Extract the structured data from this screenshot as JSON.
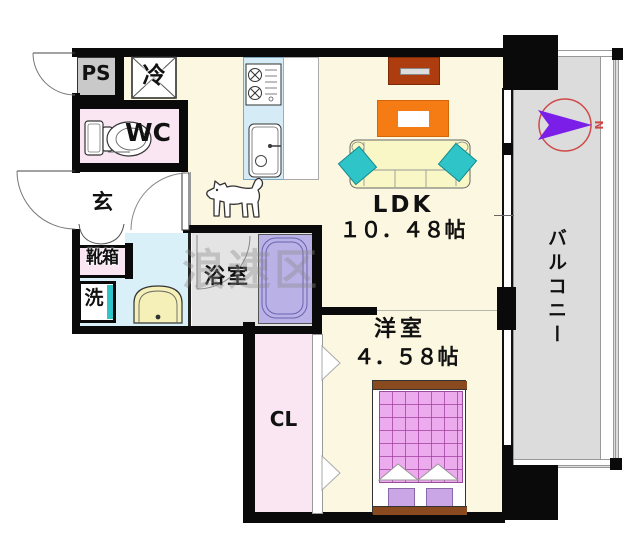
{
  "watermark": {
    "text": "浪速区"
  },
  "rooms": {
    "ps": {
      "label": "PS"
    },
    "fridge": {
      "label": "冷"
    },
    "wc": {
      "label": "WC"
    },
    "genkan": {
      "label": "玄"
    },
    "shoebox": {
      "label": "靴箱"
    },
    "laundry": {
      "label": "洗"
    },
    "bathroom": {
      "label": "浴室"
    },
    "closet": {
      "label": "CL"
    },
    "ldk": {
      "label": "LDK",
      "size": "１０．４８帖"
    },
    "bedroom": {
      "label": "洋室",
      "size": "４．５８帖"
    },
    "balcony": {
      "label": "バルコニー"
    }
  },
  "compass": {
    "north_label": "N"
  },
  "colors": {
    "floor_cream": "#FBF7E0",
    "room_pink": "#F9E6F2",
    "washroom_blue": "#D9F0F8",
    "bath_gray": "#E4E4E4",
    "tub_lavender": "#BAB2E6",
    "balcony_gray": "#DCDCDC",
    "ps_gray": "#C9C9C9",
    "kitchen_blue": "#D5ECF6",
    "sofa_cream": "#F8F7C5",
    "cushion_teal": "#2EC4C8",
    "table_orange": "#F57C14",
    "tv_brown": "#AD3D0F",
    "bed_pink": "#ECABEC",
    "bed_frame_brown": "#8A4A1F",
    "pillow_lavender": "#CBA6E6",
    "compass_ring": "#D04848",
    "compass_arrow": "#7B1FE8",
    "wall_black": "#0A0A0A",
    "watermark_gray": "#8A8A8A"
  }
}
